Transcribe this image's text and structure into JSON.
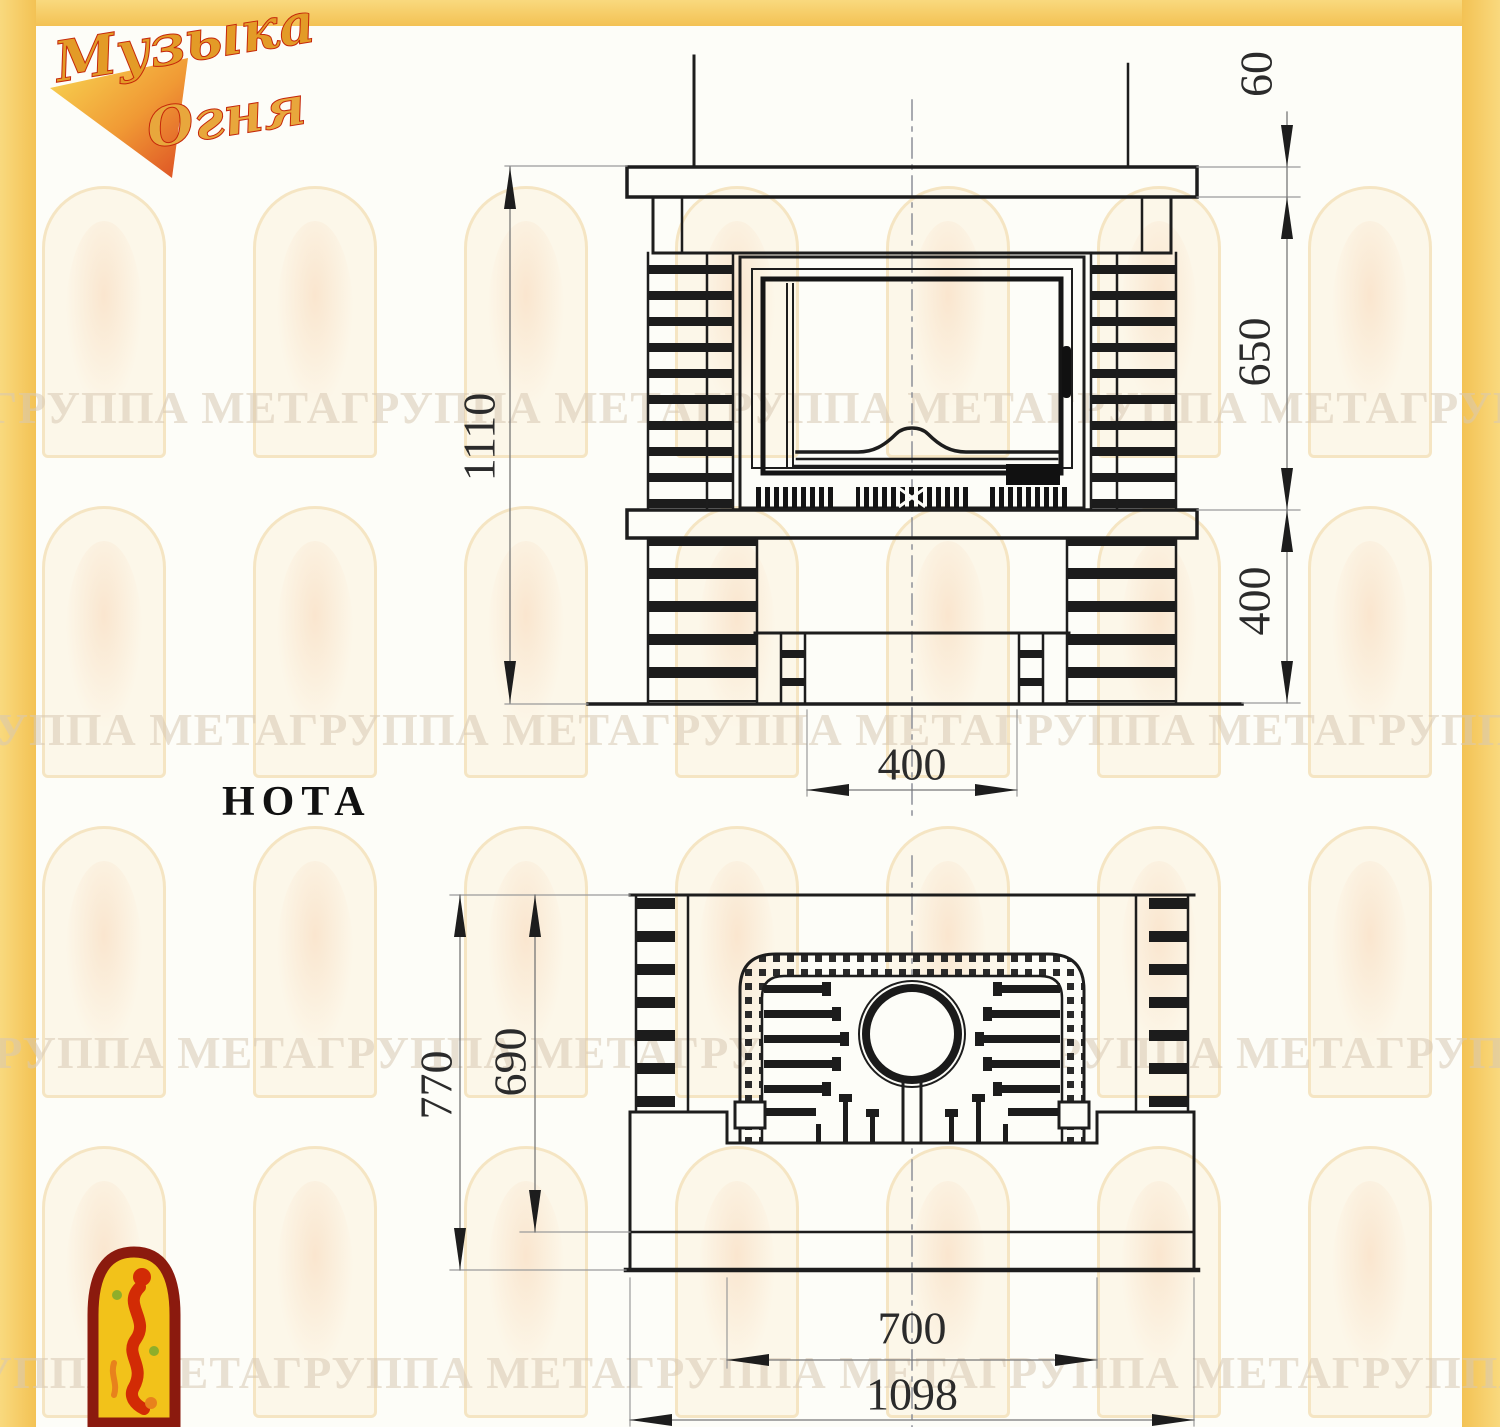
{
  "page": {
    "product_label": "НОТА"
  },
  "brand_logo": {
    "word1": "Музыка",
    "word2": "Огня"
  },
  "watermark": {
    "row_text": "ГРУППА МЕТАГРУППА МЕТАГРУППА МЕТАГРУППА МЕТАГРУППА МЕТАГРУППА МЕТА"
  },
  "front_view": {
    "dim_mantel_thickness": "60",
    "dim_firebox_height": "650",
    "dim_base_height": "400",
    "dim_total_height": "1110",
    "dim_pedestal_width": "400"
  },
  "plan_view": {
    "dim_total_depth": "770",
    "dim_inner_depth": "690",
    "dim_opening_width": "700",
    "dim_total_width": "1098"
  },
  "colors": {
    "border_yellow": "#f5c75e",
    "line_dark": "#1d1d1d",
    "dim_line": "#8a8a8a",
    "logo_gold": "#e39b27",
    "logo_red": "#c5270a",
    "logo_arch_fill": "#f2c21a",
    "watermark_text": "#d8c9b4"
  }
}
